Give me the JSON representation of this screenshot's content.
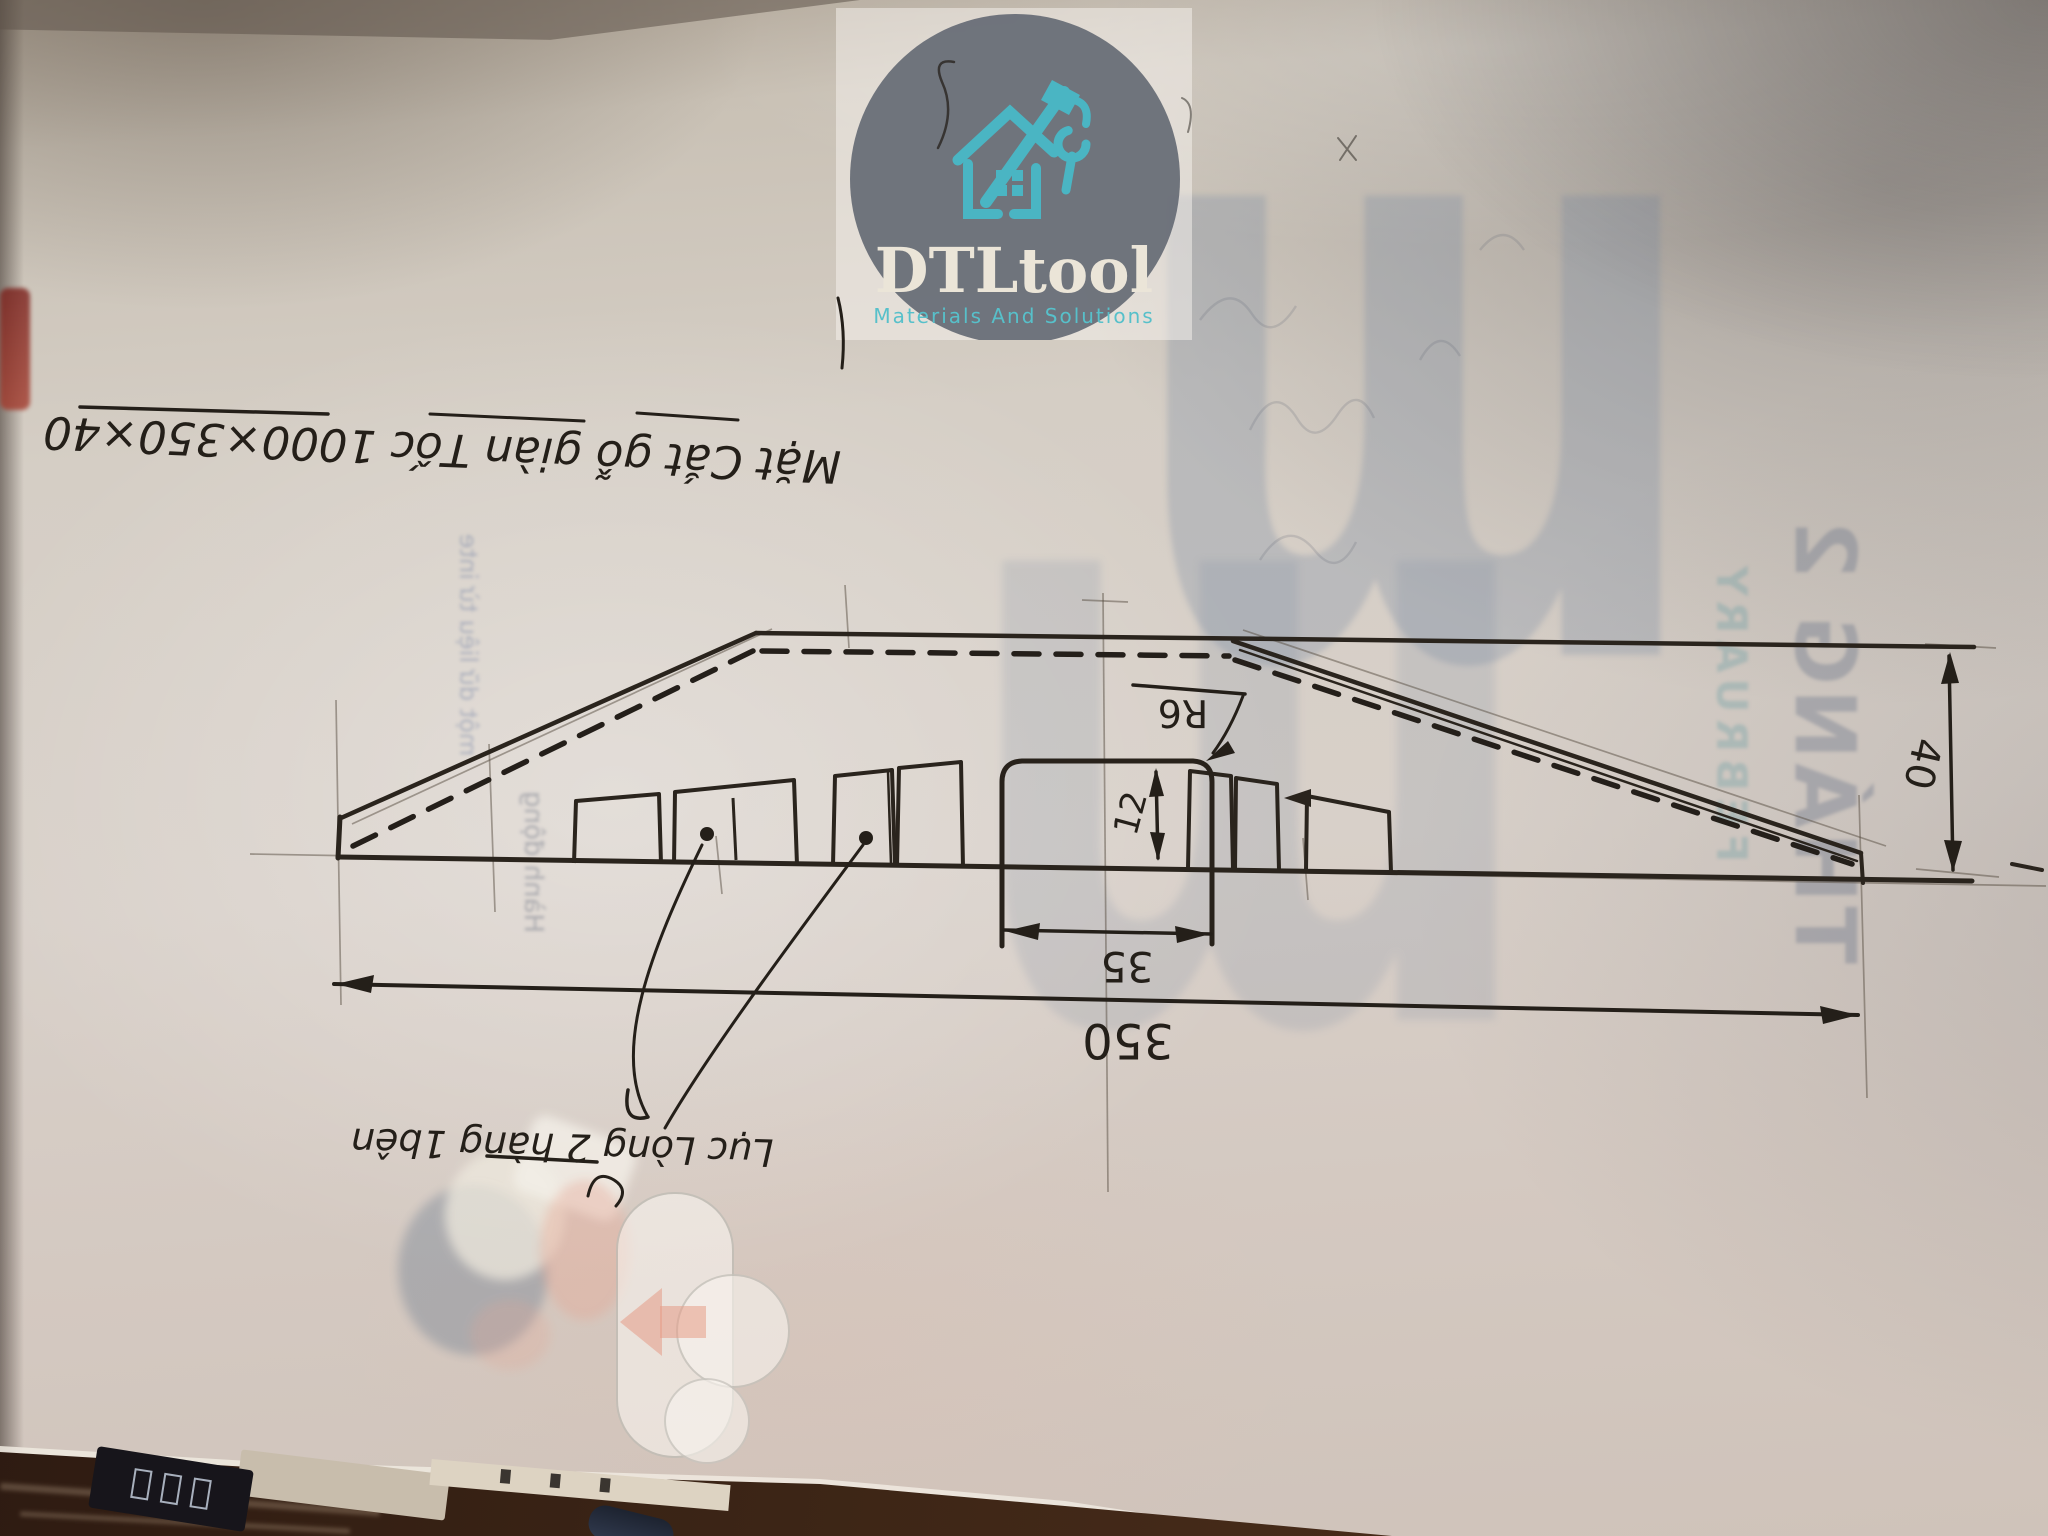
{
  "logo": {
    "name": "DTLtool",
    "tagline": "Materials And Solutions",
    "icon": "house-tools-icon",
    "colors": {
      "circle": "#666c75",
      "accent": "#4ab5c3",
      "name_text": "#ebe5d8"
    }
  },
  "sketch": {
    "title": "Mặt Cắt gỗ giàn Tốc 1000×350×40",
    "note": "Lục Lòng 2 hàng 1bên",
    "dims": {
      "overall": "350",
      "groove_width": "35",
      "groove_depth": "12",
      "radius": "R6",
      "thickness": "40"
    },
    "ink_color": "#241f19"
  },
  "ghost": {
    "month": "THÁNG 2",
    "month_en": "FEBRUARY",
    "brand_letter": "m",
    "quote_fragment_1": "một dữ liệu từ inte",
    "quote_fragment_2": "Hành động",
    "icon": "download-cloud-icon"
  }
}
